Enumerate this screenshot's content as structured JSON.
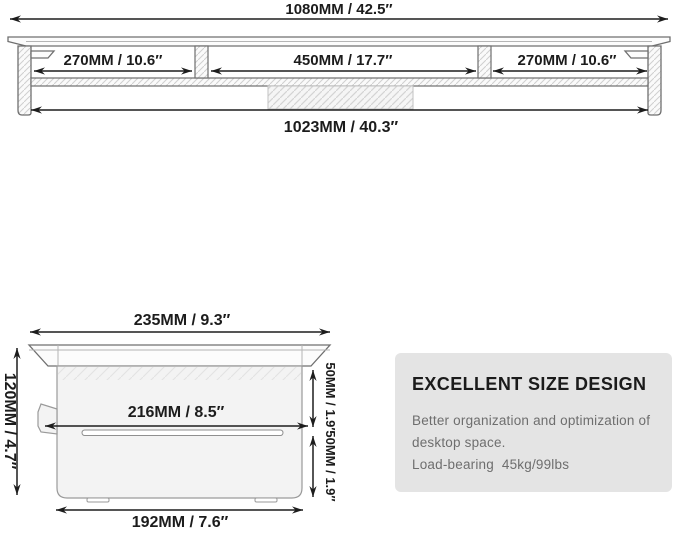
{
  "front_view": {
    "total_width_label": "1080MM / 42.5″",
    "left_shelf_label": "270MM / 10.6″",
    "center_shelf_label": "450MM / 17.7″",
    "right_shelf_label": "270MM / 10.6″",
    "inner_width_label": "1023MM / 40.3″"
  },
  "side_view": {
    "top_depth_label": "235MM / 9.3″",
    "height_label": "120MM / 4.7″",
    "inner_depth_label": "216MM / 8.5″",
    "upper_clearance_label": "50MM / 1.9″",
    "lower_clearance_label": "50MM / 1.9″",
    "base_depth_label": "192MM / 7.6″"
  },
  "info_box": {
    "title": "EXCELLENT SIZE DESIGN",
    "description_line1": "Better organization and optimization of",
    "description_line2": "desktop space.",
    "load_bearing_line": "Load-bearing  45kg/99lbs"
  },
  "colors": {
    "dimension_line": "#1d1d1d",
    "structure_line": "#6f6f6f",
    "info_box_bg": "#e4e4e4",
    "info_body_text": "#6e6e6e",
    "background": "#ffffff"
  }
}
